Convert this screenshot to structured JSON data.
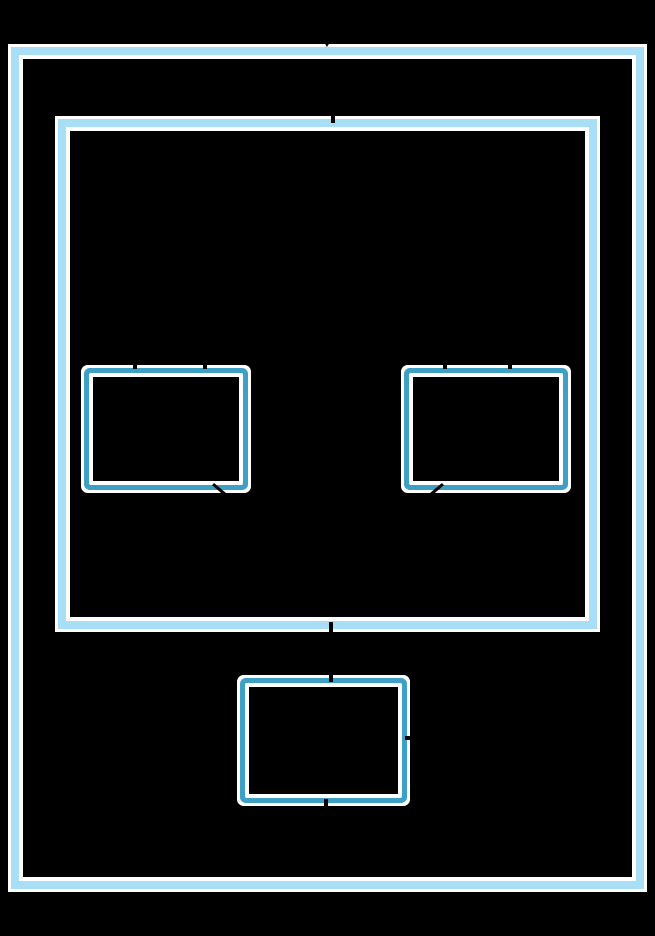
{
  "colors": {
    "canvas_background": "#000000",
    "cluster_border": "#a9def7",
    "node_border": "#3fa0c6",
    "border_casing": "#ffffff",
    "edge_color": "#000000"
  },
  "diagram": {
    "type": "cluster-graph",
    "visible_text": "",
    "clusters": [
      {
        "id": "outer-cluster",
        "label": ""
      },
      {
        "id": "inner-cluster",
        "label": ""
      }
    ],
    "nodes": [
      {
        "id": "node-left",
        "label": ""
      },
      {
        "id": "node-right",
        "label": ""
      },
      {
        "id": "node-bottom",
        "label": ""
      }
    ],
    "edge_fragments": [
      {
        "id": "arrowhead-into-outer-cluster-top",
        "shape": "triangle-down"
      },
      {
        "id": "edge-crossing-inner-cluster-top",
        "shape": "notch"
      },
      {
        "id": "edge-into-node-left-top-1",
        "shape": "notch"
      },
      {
        "id": "edge-into-node-left-top-2",
        "shape": "notch"
      },
      {
        "id": "edge-into-node-right-top-1",
        "shape": "notch"
      },
      {
        "id": "edge-into-node-right-top-2",
        "shape": "notch"
      },
      {
        "id": "edge-out-node-left-bottom-right",
        "shape": "diagonal-stub"
      },
      {
        "id": "edge-out-node-right-bottom-left",
        "shape": "diagonal-stub"
      },
      {
        "id": "edge-crossing-inner-cluster-bottom",
        "shape": "notch"
      },
      {
        "id": "edge-into-node-bottom-top",
        "shape": "notch"
      },
      {
        "id": "edge-at-node-bottom-right",
        "shape": "notch"
      },
      {
        "id": "edge-out-node-bottom-bottom",
        "shape": "notch"
      }
    ]
  }
}
